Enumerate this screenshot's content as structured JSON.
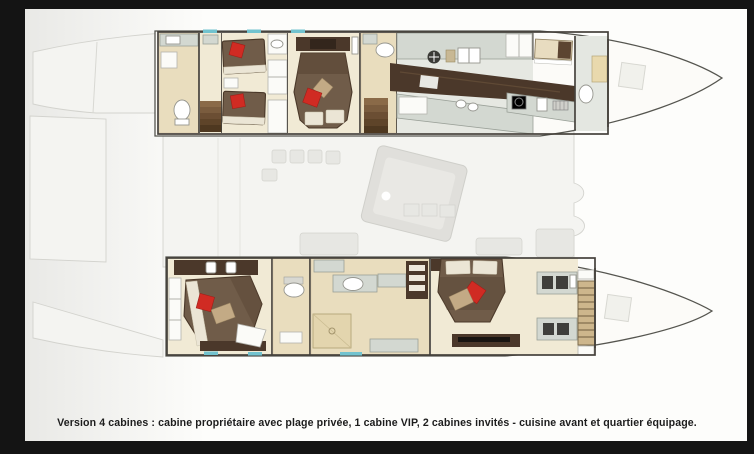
{
  "caption": "Version 4 cabines : cabine propriétaire avec plage privée, 1 cabine VIP, 2 cabines invités - cuisine avant et quartier équipage.",
  "figure": {
    "type": "catamaran-interior-deck-plan",
    "hull_top_areas": [
      "guest-bathroom",
      "stair-hall",
      "twin-guest-cabin",
      "vip-cabin",
      "vip-head",
      "galley",
      "crew-cabin",
      "crew-head",
      "bow-locker"
    ],
    "hull_bottom_areas": [
      "guest-double-cabin",
      "guest-head",
      "owner-bathroom",
      "owner-cabin",
      "companionway-steps",
      "bow-locker"
    ],
    "bridge_deck_areas": [
      "aft-platform",
      "transom-steps",
      "cockpit-saloon-ghosted"
    ]
  },
  "colors": {
    "backdrop": "#141414",
    "canvas": "#fdfdfb",
    "hull_fill": "#fcfbf8",
    "hull_outline": "#55554f",
    "wall": "#45413b",
    "floor_cream": "#f1ead5",
    "floor_tan": "#e9ddbe",
    "wood_dark": "#4b382a",
    "bed_brown": "#705c49",
    "bed_brown_dark": "#4a3829",
    "sheet_cream": "#ebe5d5",
    "pillow_red": "#d02b23",
    "pillow_tan": "#c3aa85",
    "counter_gray": "#d3d8d1",
    "ghost_fill": "#f4f4f1",
    "ghost_stroke": "#d3d3ce",
    "window_teal": "#72c3cf",
    "caption_text": "#1d1d1d"
  }
}
